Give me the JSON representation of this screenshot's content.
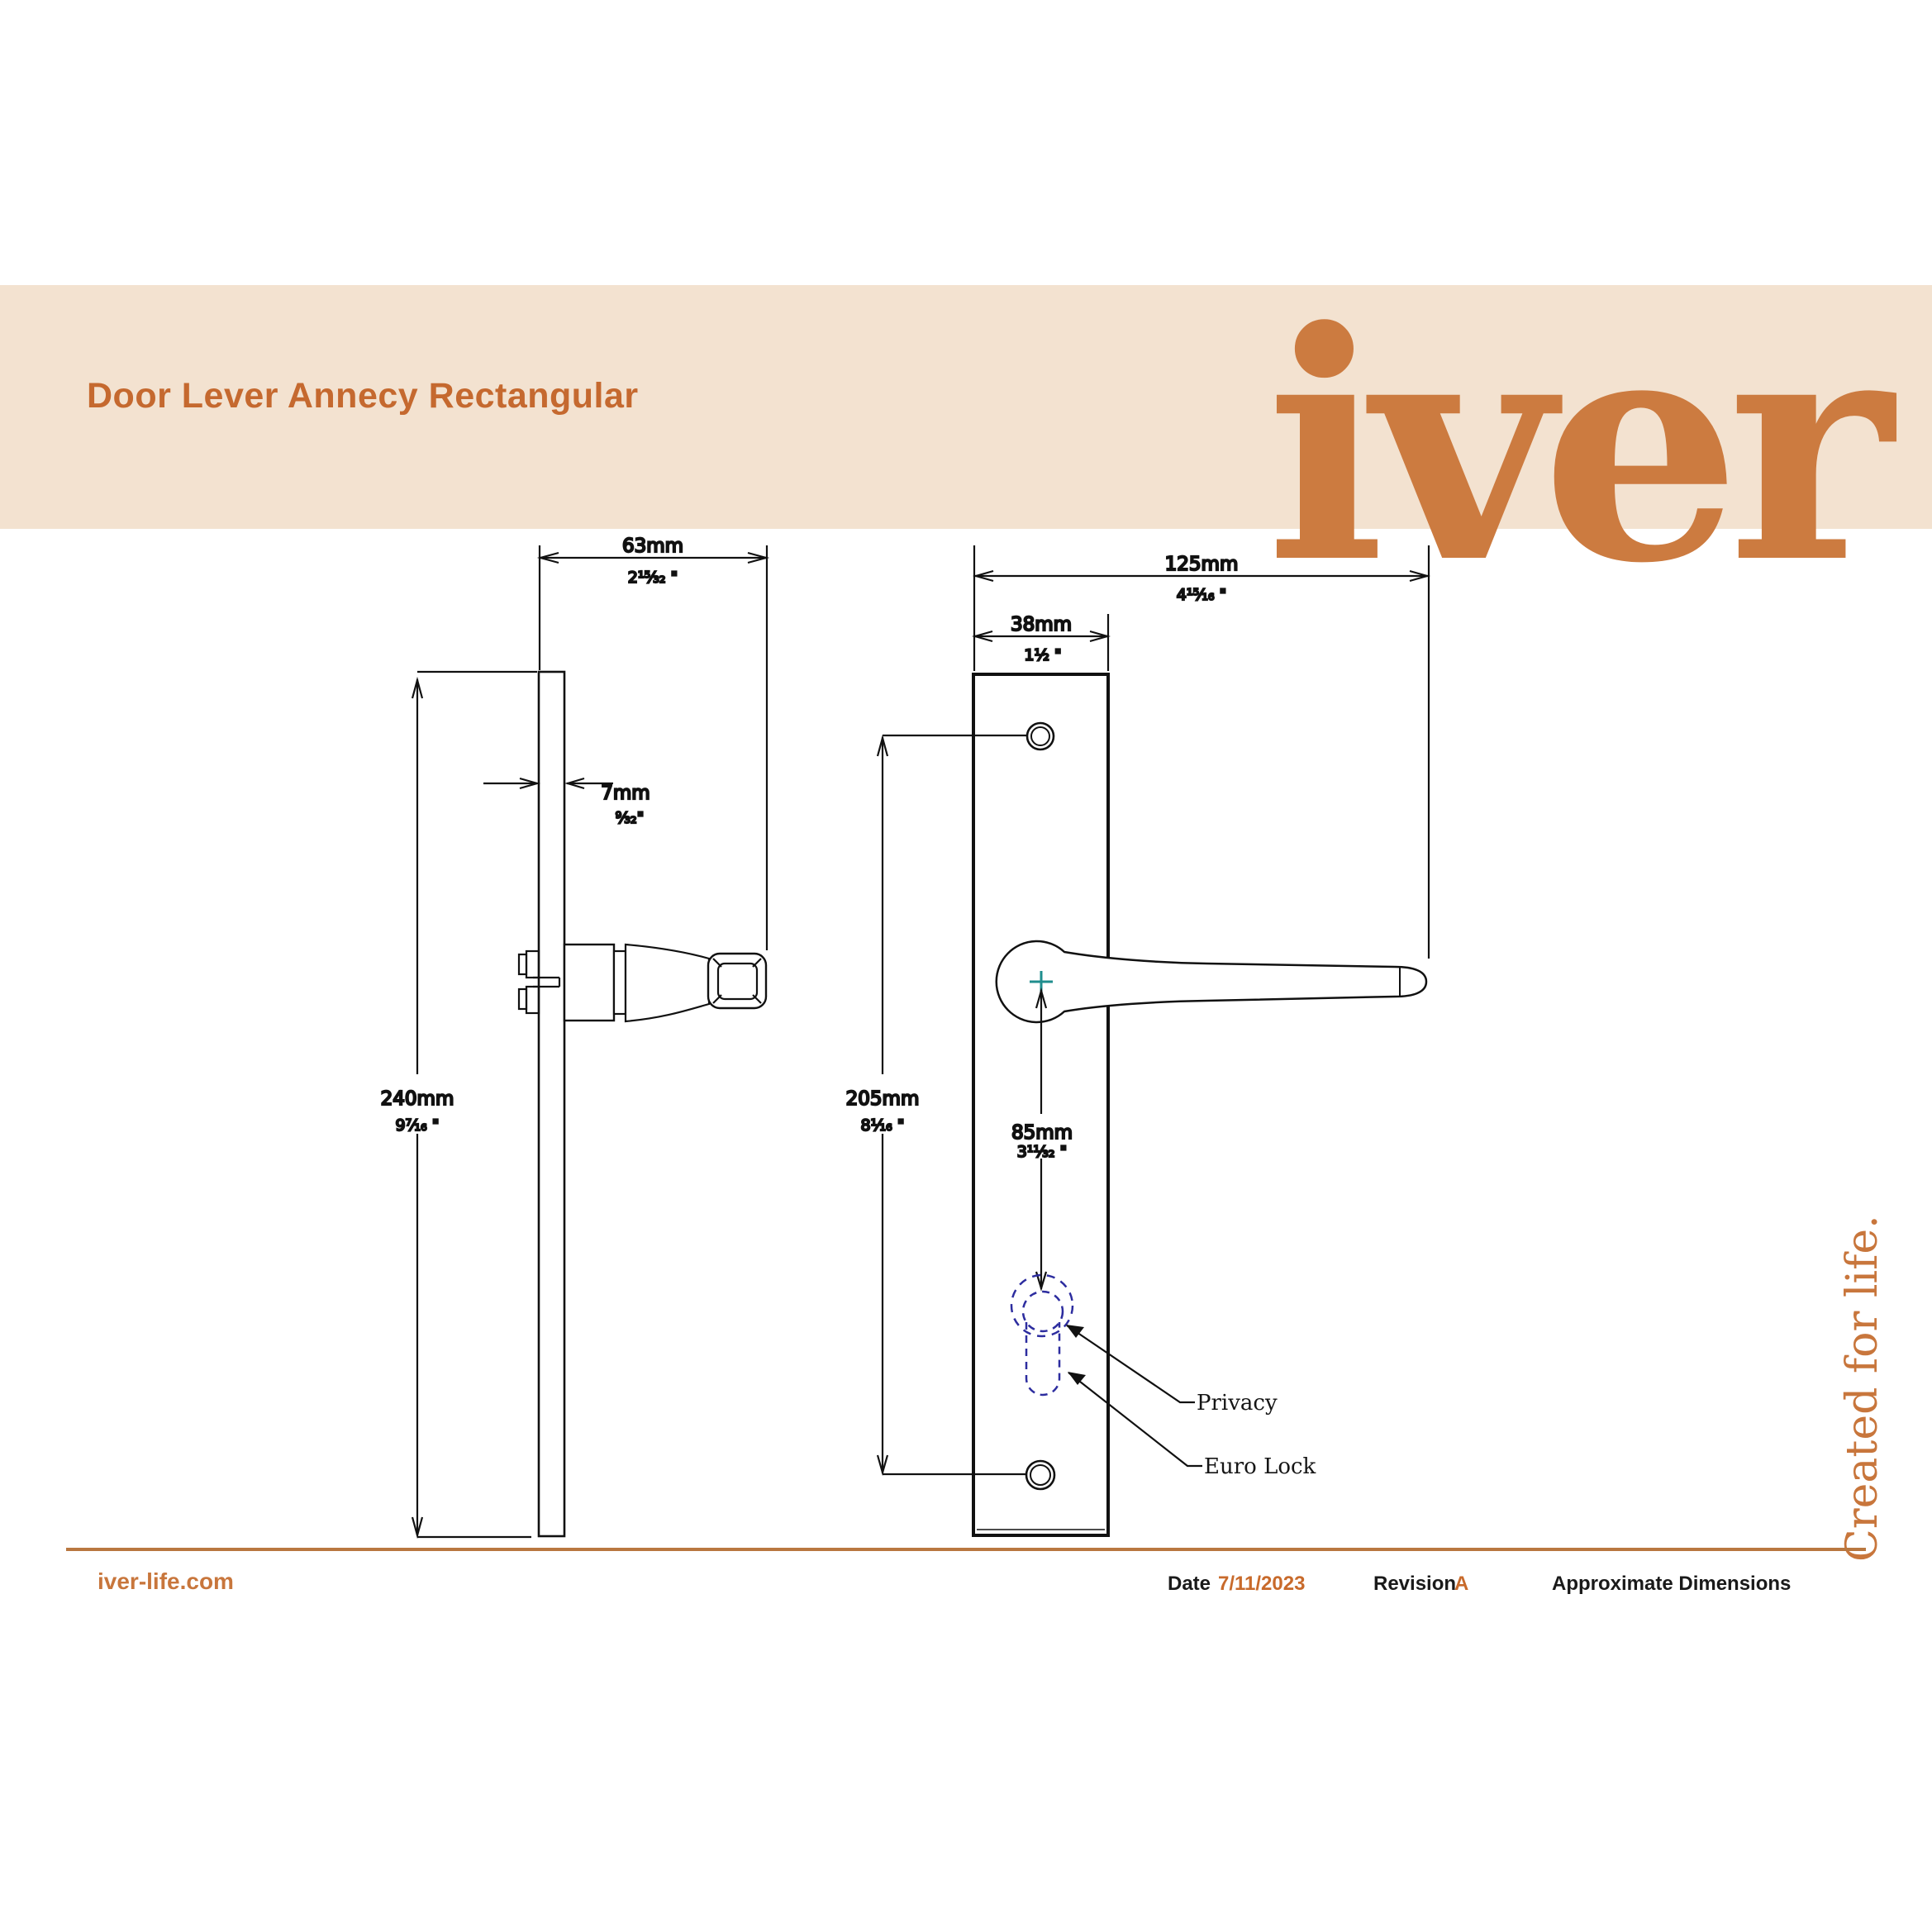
{
  "header": {
    "title": "Door Lever Annecy Rectangular",
    "logo": "iver"
  },
  "drawing": {
    "side_view": {
      "projection": {
        "mm": "63mm",
        "inch": "2¹⁵⁄₃₂ \""
      },
      "thickness": {
        "mm": "7mm",
        "inch": "⁹⁄₃₂\""
      },
      "height": {
        "mm": "240mm",
        "inch": "9⁷⁄₁₆ \""
      }
    },
    "front_view": {
      "total_width": {
        "mm": "125mm",
        "inch": "4¹⁵⁄₁₆ \""
      },
      "plate_width": {
        "mm": "38mm",
        "inch": "1¹⁄₂ \""
      },
      "fixing_centres": {
        "mm": "205mm",
        "inch": "8¹⁄₁₆ \""
      },
      "lock_centre": {
        "mm": "85mm",
        "inch": "3¹¹⁄₃₂ \""
      },
      "privacy_label": "Privacy",
      "euro_label": "Euro Lock"
    }
  },
  "tagline": "Created for life.",
  "footer": {
    "website": "iver-life.com",
    "date_label": "Date",
    "date_value": "7/11/2023",
    "revision_label": "Revision",
    "revision_value": "A",
    "note": "Approximate Dimensions"
  },
  "colors": {
    "accent": "#C8763C",
    "band": "#F3E2D0",
    "line": "#111111",
    "centre_mark": "#1F8E8E",
    "lock_outline": "#2D2D9F",
    "separator": "#B97740"
  }
}
